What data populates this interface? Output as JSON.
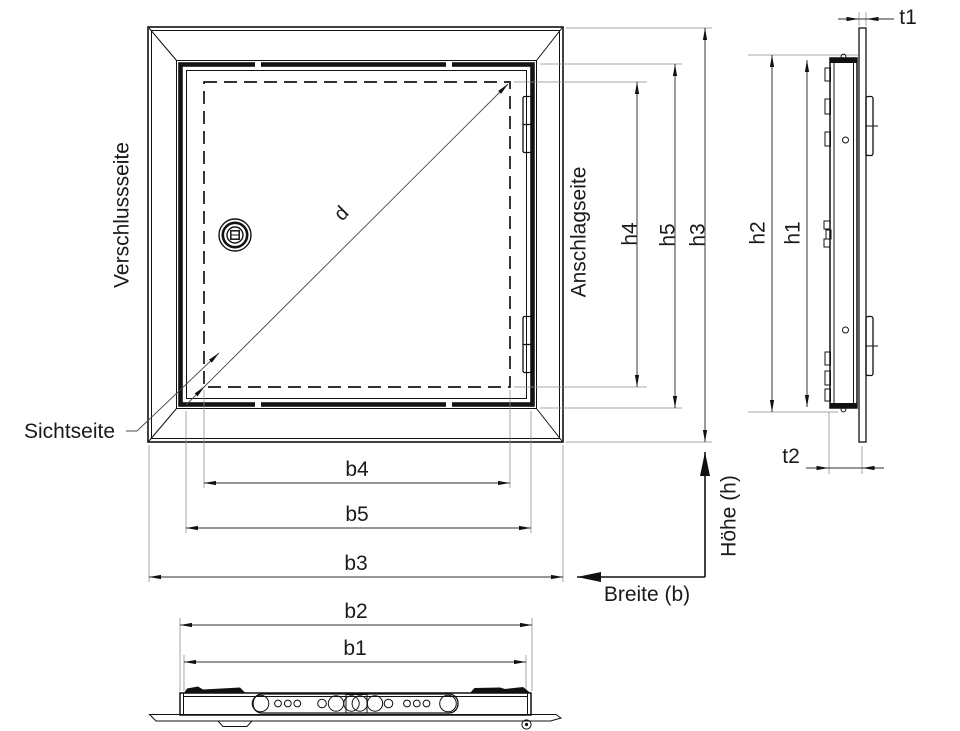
{
  "drawing": {
    "type": "technical-drawing",
    "views": [
      "front-view",
      "side-view",
      "bottom-view"
    ],
    "labels": {
      "verschlussseite": "Verschlussseite",
      "anschlagseite": "Anschlagseite",
      "sichtseite": "Sichtseite",
      "d": "d",
      "b1": "b1",
      "b2": "b2",
      "b3": "b3",
      "b4": "b4",
      "b5": "b5",
      "h1": "h1",
      "h2": "h2",
      "h3": "h3",
      "h4": "h4",
      "h5": "h5",
      "t1": "t1",
      "t2": "t2",
      "hoehe_axis": "Höhe (h)",
      "breite_axis": "Breite (b)"
    },
    "colors": {
      "line": "#111111",
      "dim": "#2e2e2e",
      "ext": "#8a8a8a",
      "bg": "#ffffff"
    }
  }
}
